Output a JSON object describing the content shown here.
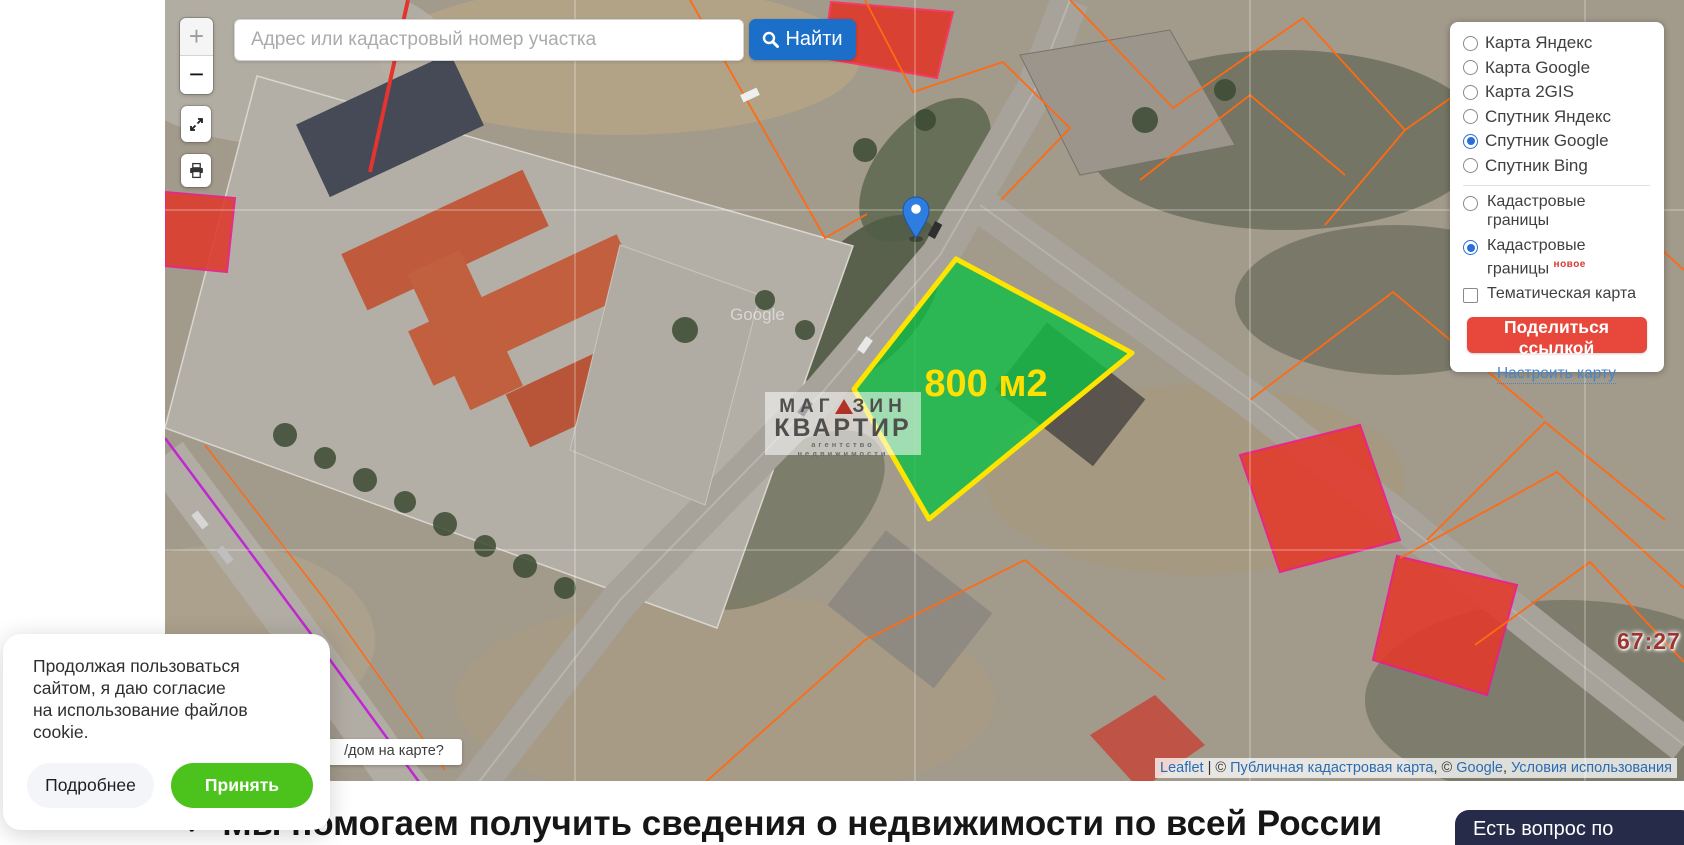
{
  "search": {
    "placeholder": "Адрес или кадастровый номер участка",
    "find_button": "Найти"
  },
  "zoom_control": {
    "zoom_in": "+",
    "zoom_out": "−"
  },
  "icons": {
    "find": "magnifier",
    "fullscreen": "expand-arrows",
    "print": "printer"
  },
  "layers_panel": {
    "base_layers": [
      {
        "label": "Карта Яндекс",
        "selected": false
      },
      {
        "label": "Карта Google",
        "selected": false
      },
      {
        "label": "Карта 2GIS",
        "selected": false
      },
      {
        "label": "Спутник Яндекс",
        "selected": false
      },
      {
        "label": "Спутник Google",
        "selected": true
      },
      {
        "label": "Спутник Bing",
        "selected": false
      }
    ],
    "overlays": [
      {
        "label": "Кадастровые границы",
        "type": "radio",
        "selected": false
      },
      {
        "label_line1": "Кадастровые",
        "label_line2": "границы",
        "badge": "новое",
        "type": "radio",
        "selected": true
      },
      {
        "label": "Тематическая карта",
        "type": "checkbox",
        "selected": false
      }
    ],
    "share_button": "Поделиться ссылкой",
    "configure_link": "Настроить карту"
  },
  "map": {
    "parcel_label": "800 м2",
    "district_label": "67:27",
    "google_watermark": "Google",
    "agency_watermark": {
      "line1a": "МАГ",
      "line1b": "ЗИН",
      "line2": "КВАРТИР",
      "line3": "агентство недвижимости"
    },
    "tooltip": "/дом на карте?",
    "attribution": {
      "leaflet": "Leaflet",
      "sep1": " | © ",
      "pkk": "Публичная кадастровая карта",
      "sep2": ", © ",
      "google": "Google",
      "sep3": ", ",
      "terms": "Условия использования"
    }
  },
  "cookie_banner": {
    "text_lines": [
      "Продолжая пользоваться",
      "сайтом, я даю согласие",
      "на использование файлов",
      "cookie."
    ],
    "more_button": "Подробнее",
    "accept_button": "Принять"
  },
  "footer": {
    "check": "✓",
    "headline": "Мы помогаем получить сведения о недвижимости по всей России",
    "chat_button": "Есть вопрос по недвижи"
  },
  "colors": {
    "accent_blue": "#1b6fc8",
    "share_red": "#e8473b",
    "accept_green": "#4cc31c",
    "parcel_fill": "#10be46",
    "parcel_stroke": "#ffe400",
    "chat_navy": "#262b49"
  }
}
